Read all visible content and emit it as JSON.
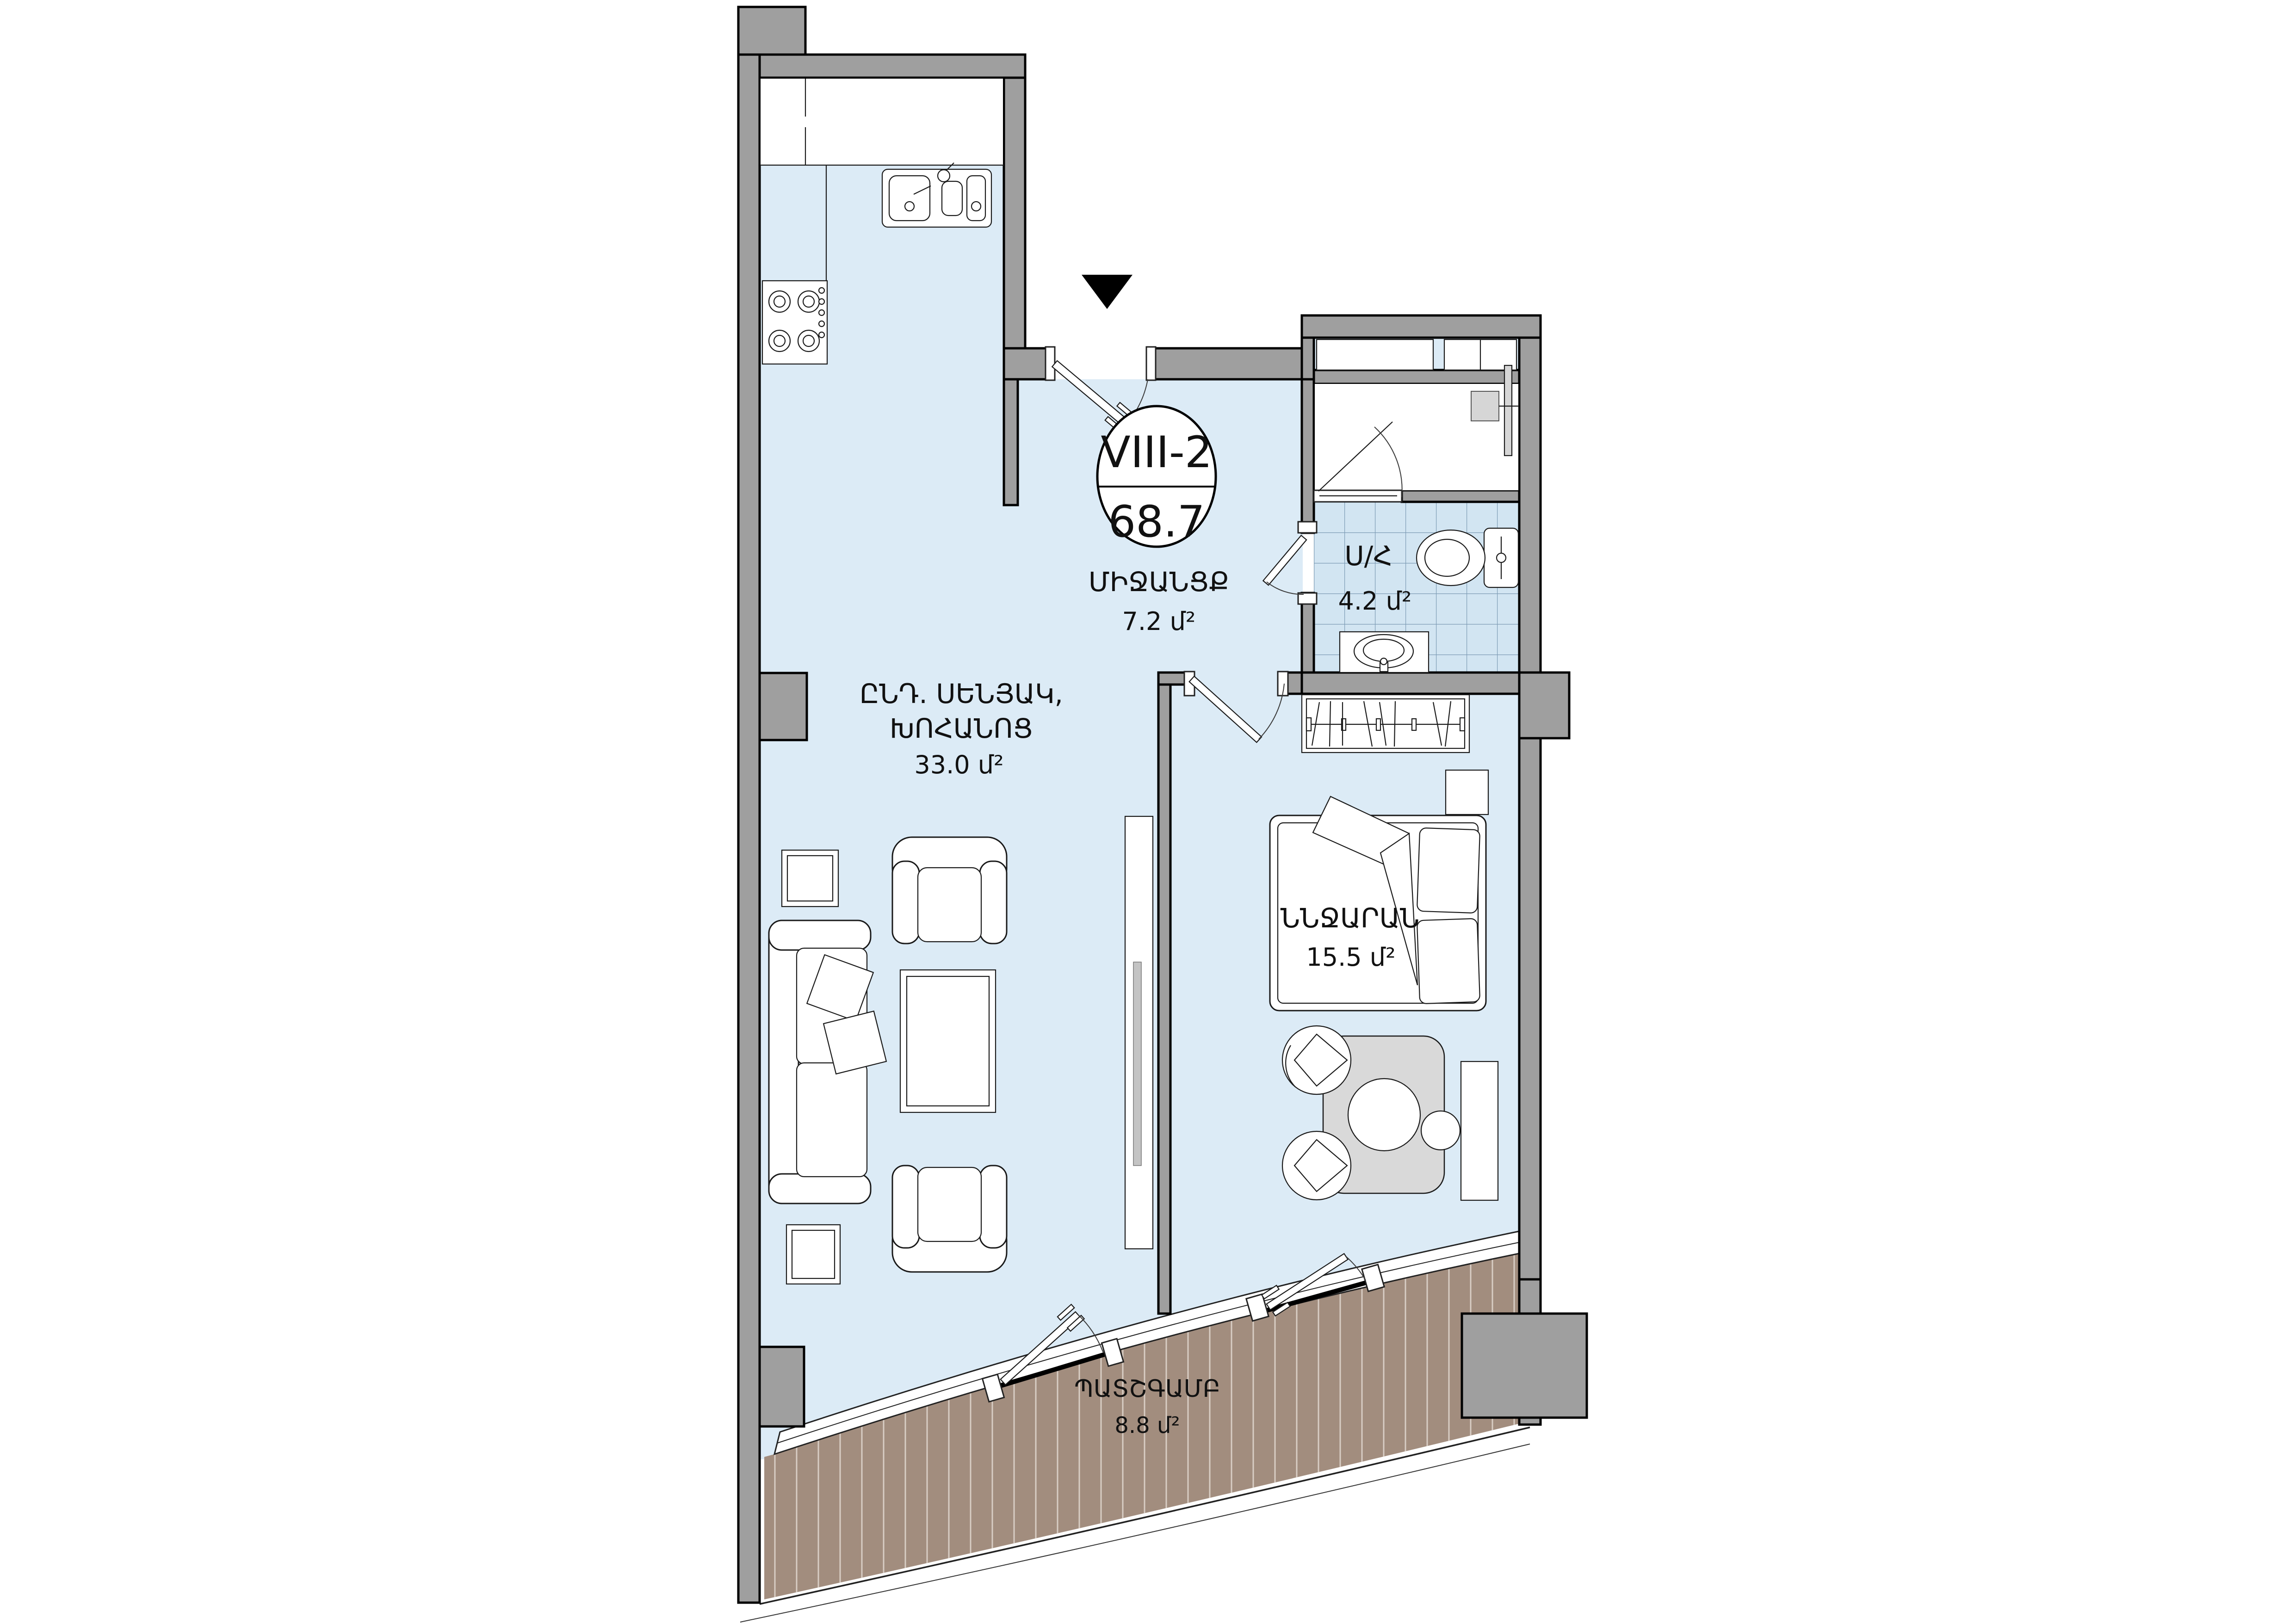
{
  "title": "Apartment floor plan VIII-2",
  "badge": {
    "unit": "VIII-2",
    "total_area": "68.7"
  },
  "rooms": {
    "living": {
      "name_line1": "ԸՆԴ. ՍԵՆՅԱԿ,",
      "name_line2": "ԽՈՀԱՆՈՑ",
      "area": "33.0 մ²"
    },
    "hallway": {
      "name": "ՄԻՋԱՆՑՔ",
      "area": "7.2 մ²"
    },
    "bath": {
      "name": "Ս/Հ",
      "area": "4.2 մ²"
    },
    "bedroom": {
      "name": "ՆՆՋԱՐԱՆ",
      "area": "15.5 մ²"
    },
    "balcony": {
      "name": "ՊԱՏՇԳԱՄԲ",
      "area": "8.8 մ²"
    }
  },
  "icons": {
    "entrance_marker": "down-triangle"
  },
  "colors": {
    "wall_fill": "#9f9f9f",
    "outline": "#000000",
    "floor": "#dcebf6",
    "tile_fill": "#d2e5f2",
    "tile_line": "#7d9cb5",
    "balcony_fill": "#a28d7e",
    "balcony_stripe": "#d8cdc4",
    "furniture_fill": "#ffffff",
    "furniture_line": "#1a1a1a",
    "table_fill": "#d9d9d9",
    "tv_fill": "#c4c4c4",
    "glass_line": "#222222",
    "text": "#111111"
  }
}
